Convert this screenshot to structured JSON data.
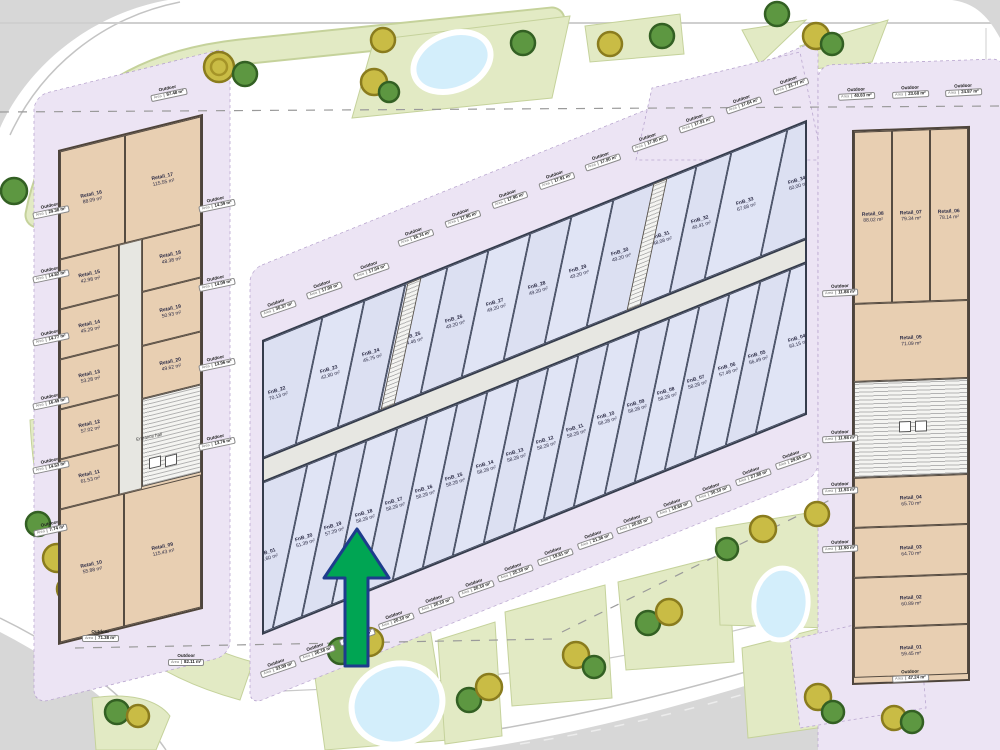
{
  "labels": {
    "outdoor": "Outdoor",
    "area_prefix": "Area",
    "entrance_hall": "Entrance hall"
  },
  "arrow": {
    "fill": "#00a553",
    "outline": "#1d3c8c"
  },
  "left_building": {
    "top_units": [
      {
        "name": "Retail_16",
        "area": "88.09 m²"
      },
      {
        "name": "Retail_17",
        "area": "115.55 m²"
      }
    ],
    "west_units": [
      {
        "name": "Retail_15",
        "area": "42.98 m²"
      },
      {
        "name": "Retail_14",
        "area": "45.29 m²"
      },
      {
        "name": "Retail_13",
        "area": "53.28 m²"
      },
      {
        "name": "Retail_12",
        "area": "57.02 m²"
      },
      {
        "name": "Retail_11",
        "area": "61.53 m²"
      }
    ],
    "east_units": [
      {
        "name": "Retail_18",
        "area": "48.38 m²"
      },
      {
        "name": "Retail_19",
        "area": "50.93 m²"
      },
      {
        "name": "Retail_20",
        "area": "49.62 m²"
      }
    ],
    "bottom_units": [
      {
        "name": "Retail_10",
        "area": "55.88 m²"
      },
      {
        "name": "Retail_09",
        "area": "115.43 m²"
      }
    ],
    "outdoor_top": [
      {
        "v": "87.48 m²"
      }
    ],
    "outdoor_west": [
      {
        "v": "29.38 m²"
      },
      {
        "v": "14.82 m²"
      },
      {
        "v": "14.77 m²"
      },
      {
        "v": "16.49 m²"
      },
      {
        "v": "14.53 m²"
      },
      {
        "v": "7.74 m²"
      }
    ],
    "outdoor_east": [
      {
        "v": "14.39 m²"
      },
      {
        "v": "14.09 m²"
      },
      {
        "v": "13.96 m²"
      },
      {
        "v": "13.76 m²"
      }
    ],
    "outdoor_bottom": [
      {
        "v": "71.38 m²"
      },
      {
        "v": "82.11 m²"
      }
    ]
  },
  "center_building": {
    "top_row": [
      {
        "name": "FnB_22",
        "area": "70.13 m²"
      },
      {
        "name": "FnB_23",
        "area": "42.80 m²"
      },
      {
        "name": "FnB_24",
        "area": "45.75 m²"
      },
      {
        "name": "FnB_25",
        "area": "44.46 m²"
      },
      {
        "name": "FnB_26",
        "area": "49.20 m²"
      },
      {
        "name": "FnB_27",
        "area": "49.20 m²"
      },
      {
        "name": "FnB_28",
        "area": "49.20 m²"
      },
      {
        "name": "FnB_29",
        "area": "49.20 m²"
      },
      {
        "name": "FnB_30",
        "area": "49.20 m²"
      },
      {
        "name": "FnB_31",
        "area": "48.08 m²"
      },
      {
        "name": "FnB_32",
        "area": "40.41 m²"
      },
      {
        "name": "FnB_33",
        "area": "67.68 m²"
      },
      {
        "name": "FnB_34",
        "area": "60.00 m²"
      }
    ],
    "bottom_row": [
      {
        "name": "FnB_01",
        "area": "80.60 m²"
      },
      {
        "name": "FnB_20",
        "area": "51.39 m²"
      },
      {
        "name": "FnB_19",
        "area": "57.29 m²"
      },
      {
        "name": "FnB_18",
        "area": "58.28 m²"
      },
      {
        "name": "FnB_17",
        "area": "58.28 m²"
      },
      {
        "name": "FnB_16",
        "area": "58.28 m²"
      },
      {
        "name": "FnB_15",
        "area": "58.28 m²"
      },
      {
        "name": "FnB_14",
        "area": "58.28 m²"
      },
      {
        "name": "FnB_13",
        "area": "58.28 m²"
      },
      {
        "name": "FnB_12",
        "area": "58.28 m²"
      },
      {
        "name": "FnB_11",
        "area": "58.28 m²"
      },
      {
        "name": "FnB_10",
        "area": "58.28 m²"
      },
      {
        "name": "FnB_09",
        "area": "58.28 m²"
      },
      {
        "name": "FnB_08",
        "area": "58.28 m²"
      },
      {
        "name": "FnB_07",
        "area": "58.28 m²"
      },
      {
        "name": "FnB_06",
        "area": "57.48 m²"
      },
      {
        "name": "FnB_05",
        "area": "56.49 m²"
      },
      {
        "name": "FnB_04",
        "area": "93.15 m²"
      }
    ],
    "outdoor_top": [
      {
        "v": "30.37 m²"
      },
      {
        "v": "17.90 m²"
      },
      {
        "v": "17.04 m²"
      },
      {
        "v": "16.74 m²"
      },
      {
        "v": "17.90 m²"
      },
      {
        "v": "17.90 m²"
      },
      {
        "v": "17.91 m²"
      },
      {
        "v": "17.90 m²"
      },
      {
        "v": "17.90 m²"
      },
      {
        "v": "17.91 m²"
      },
      {
        "v": "17.64 m²"
      },
      {
        "v": "21.77 m²"
      }
    ],
    "outdoor_bottom": [
      {
        "v": "33.09 m²"
      },
      {
        "v": "26.18 m²"
      },
      {
        "v": "20.10 m²"
      },
      {
        "v": "20.10 m²"
      },
      {
        "v": "20.10 m²"
      },
      {
        "v": "20.10 m²"
      },
      {
        "v": "25.10 m²"
      },
      {
        "v": "19.61 m²"
      },
      {
        "v": "21.36 m²"
      },
      {
        "v": "20.65 m²"
      },
      {
        "v": "19.60 m²"
      },
      {
        "v": "30.10 m²"
      },
      {
        "v": "27.88 m²"
      },
      {
        "v": "29.65 m²"
      }
    ]
  },
  "right_building": {
    "top_units": [
      {
        "name": "Retail_08",
        "area": "88.02 m²"
      },
      {
        "name": "Retail_07",
        "area": "79.34 m²"
      },
      {
        "name": "Retail_06",
        "area": "78.14 m²"
      }
    ],
    "mid_units": [
      {
        "name": "Retail_05",
        "area": "71.09 m²"
      }
    ],
    "bottom_units": [
      {
        "name": "Retail_04",
        "area": "65.70 m²"
      },
      {
        "name": "Retail_03",
        "area": "64.70 m²"
      },
      {
        "name": "Retail_02",
        "area": "60.89 m²"
      },
      {
        "name": "Retail_01",
        "area": "59.45 m²"
      }
    ],
    "outdoor_top": [
      {
        "v": "40.83 m²"
      },
      {
        "v": "23.68 m²"
      },
      {
        "v": "24.87 m²"
      }
    ],
    "outdoor_west": [
      {
        "v": "11.88 m²"
      },
      {
        "v": "11.98 m²"
      },
      {
        "v": "11.93 m²"
      },
      {
        "v": "11.90 m²"
      }
    ],
    "outdoor_bottom": [
      {
        "v": "47.24 m²"
      }
    ]
  }
}
